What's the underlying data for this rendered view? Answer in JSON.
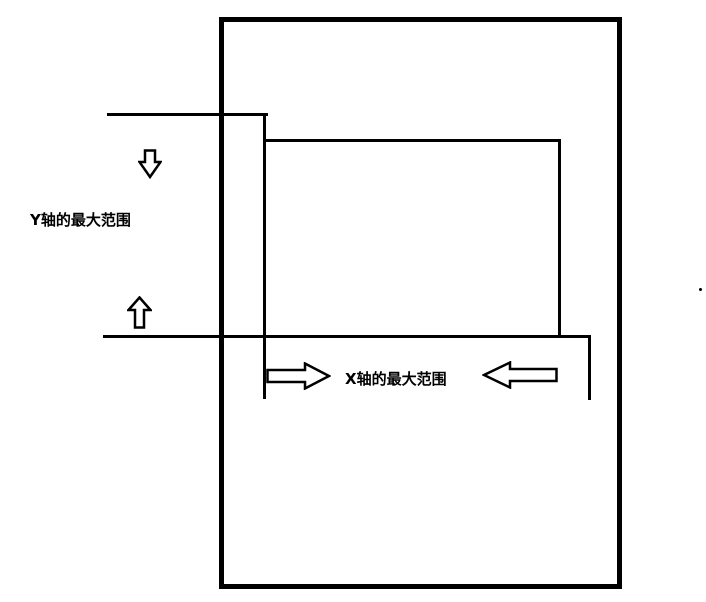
{
  "drawing": {
    "background_color": "#ffffff",
    "ink_color": "#000000",
    "labels": {
      "y_axis_range": "Y轴的最大范围",
      "x_axis_range": "X轴的最大范围"
    },
    "icons": {
      "down_arrow": "down-block-arrow-icon",
      "up_arrow": "up-block-arrow-icon",
      "right_arrow": "right-block-arrow-icon",
      "left_arrow": "left-block-arrow-icon"
    }
  }
}
